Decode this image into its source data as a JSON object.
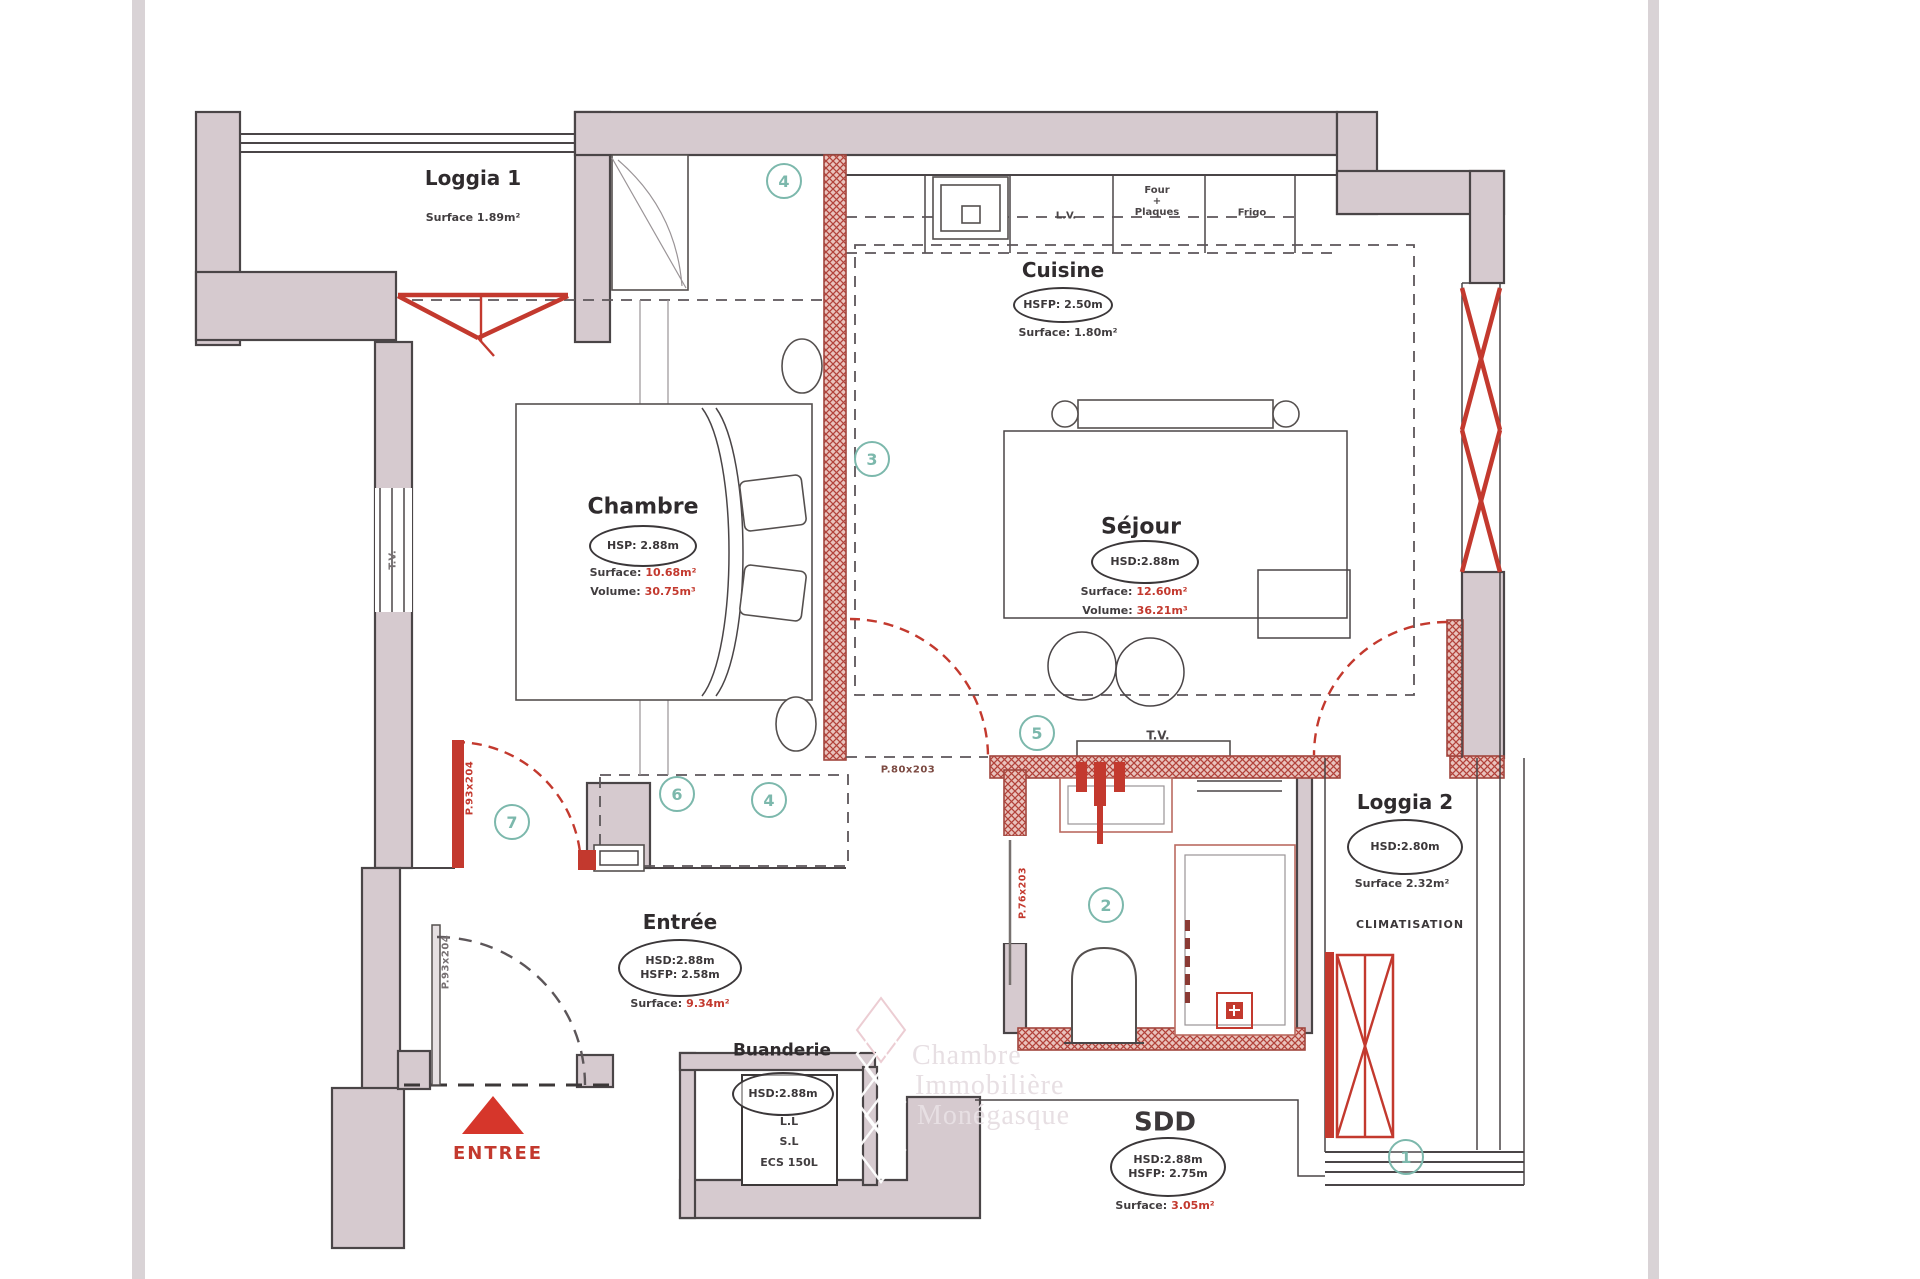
{
  "plan": {
    "colors": {
      "wall_fill": "#d6cacf",
      "wall_line": "#4a4547",
      "red": "#c3392e",
      "teal": "#7cb8ac",
      "gutter": "#d9d3d6"
    },
    "rooms": {
      "loggia1": {
        "name": "Loggia 1",
        "surface": "Surface 1.89m²"
      },
      "cuisine": {
        "name": "Cuisine",
        "ellipse": "HSFP: 2.50m",
        "surface": "Surface: 1.80m²"
      },
      "chambre": {
        "name": "Chambre",
        "ellipse": "HSP: 2.88m",
        "surface_label": "Surface:",
        "surface_value": "10.68m²",
        "volume_label": "Volume:",
        "volume_value": "30.75m³"
      },
      "sejour": {
        "name": "Séjour",
        "ellipse": "HSD:2.88m",
        "surface_label": "Surface:",
        "surface_value": "12.60m²",
        "volume_label": "Volume:",
        "volume_value": "36.21m³"
      },
      "entree": {
        "name": "Entrée",
        "ellipse_line1": "HSD:2.88m",
        "ellipse_line2": "HSFP: 2.58m",
        "surface_label": "Surface:",
        "surface_value": "9.34m²"
      },
      "buanderie": {
        "name": "Buanderie",
        "ellipse": "HSD:2.88m",
        "equipment": [
          "L.L",
          "S.L",
          "ECS 150L"
        ]
      },
      "sdd": {
        "name": "SDD",
        "ellipse_line1": "HSD:2.88m",
        "ellipse_line2": "HSFP: 2.75m",
        "surface_label": "Surface:",
        "surface_value": "3.05m²"
      },
      "loggia2": {
        "name": "Loggia 2",
        "ellipse": "HSD:2.80m",
        "surface": "Surface 2.32m²",
        "climatisation": "CLIMATISATION"
      }
    },
    "appliances": {
      "lv": "L.V.",
      "four_plaques": "Four\n+\nPlaques",
      "frigo": "Frigo"
    },
    "doors": {
      "sejour": "P.80x203",
      "chambre": "P.93x204",
      "entry": "P.93x204",
      "sdd": "P.76x203"
    },
    "tv_wall": "T.V.",
    "tv_window": "T.V.",
    "entree_arrow_label": "ENTREE",
    "markers": [
      "1",
      "2",
      "3",
      "4",
      "4",
      "5",
      "6",
      "7"
    ],
    "watermark": {
      "line1": "Chambre",
      "line2": "Immobilière",
      "line3": "Monégasque"
    }
  }
}
